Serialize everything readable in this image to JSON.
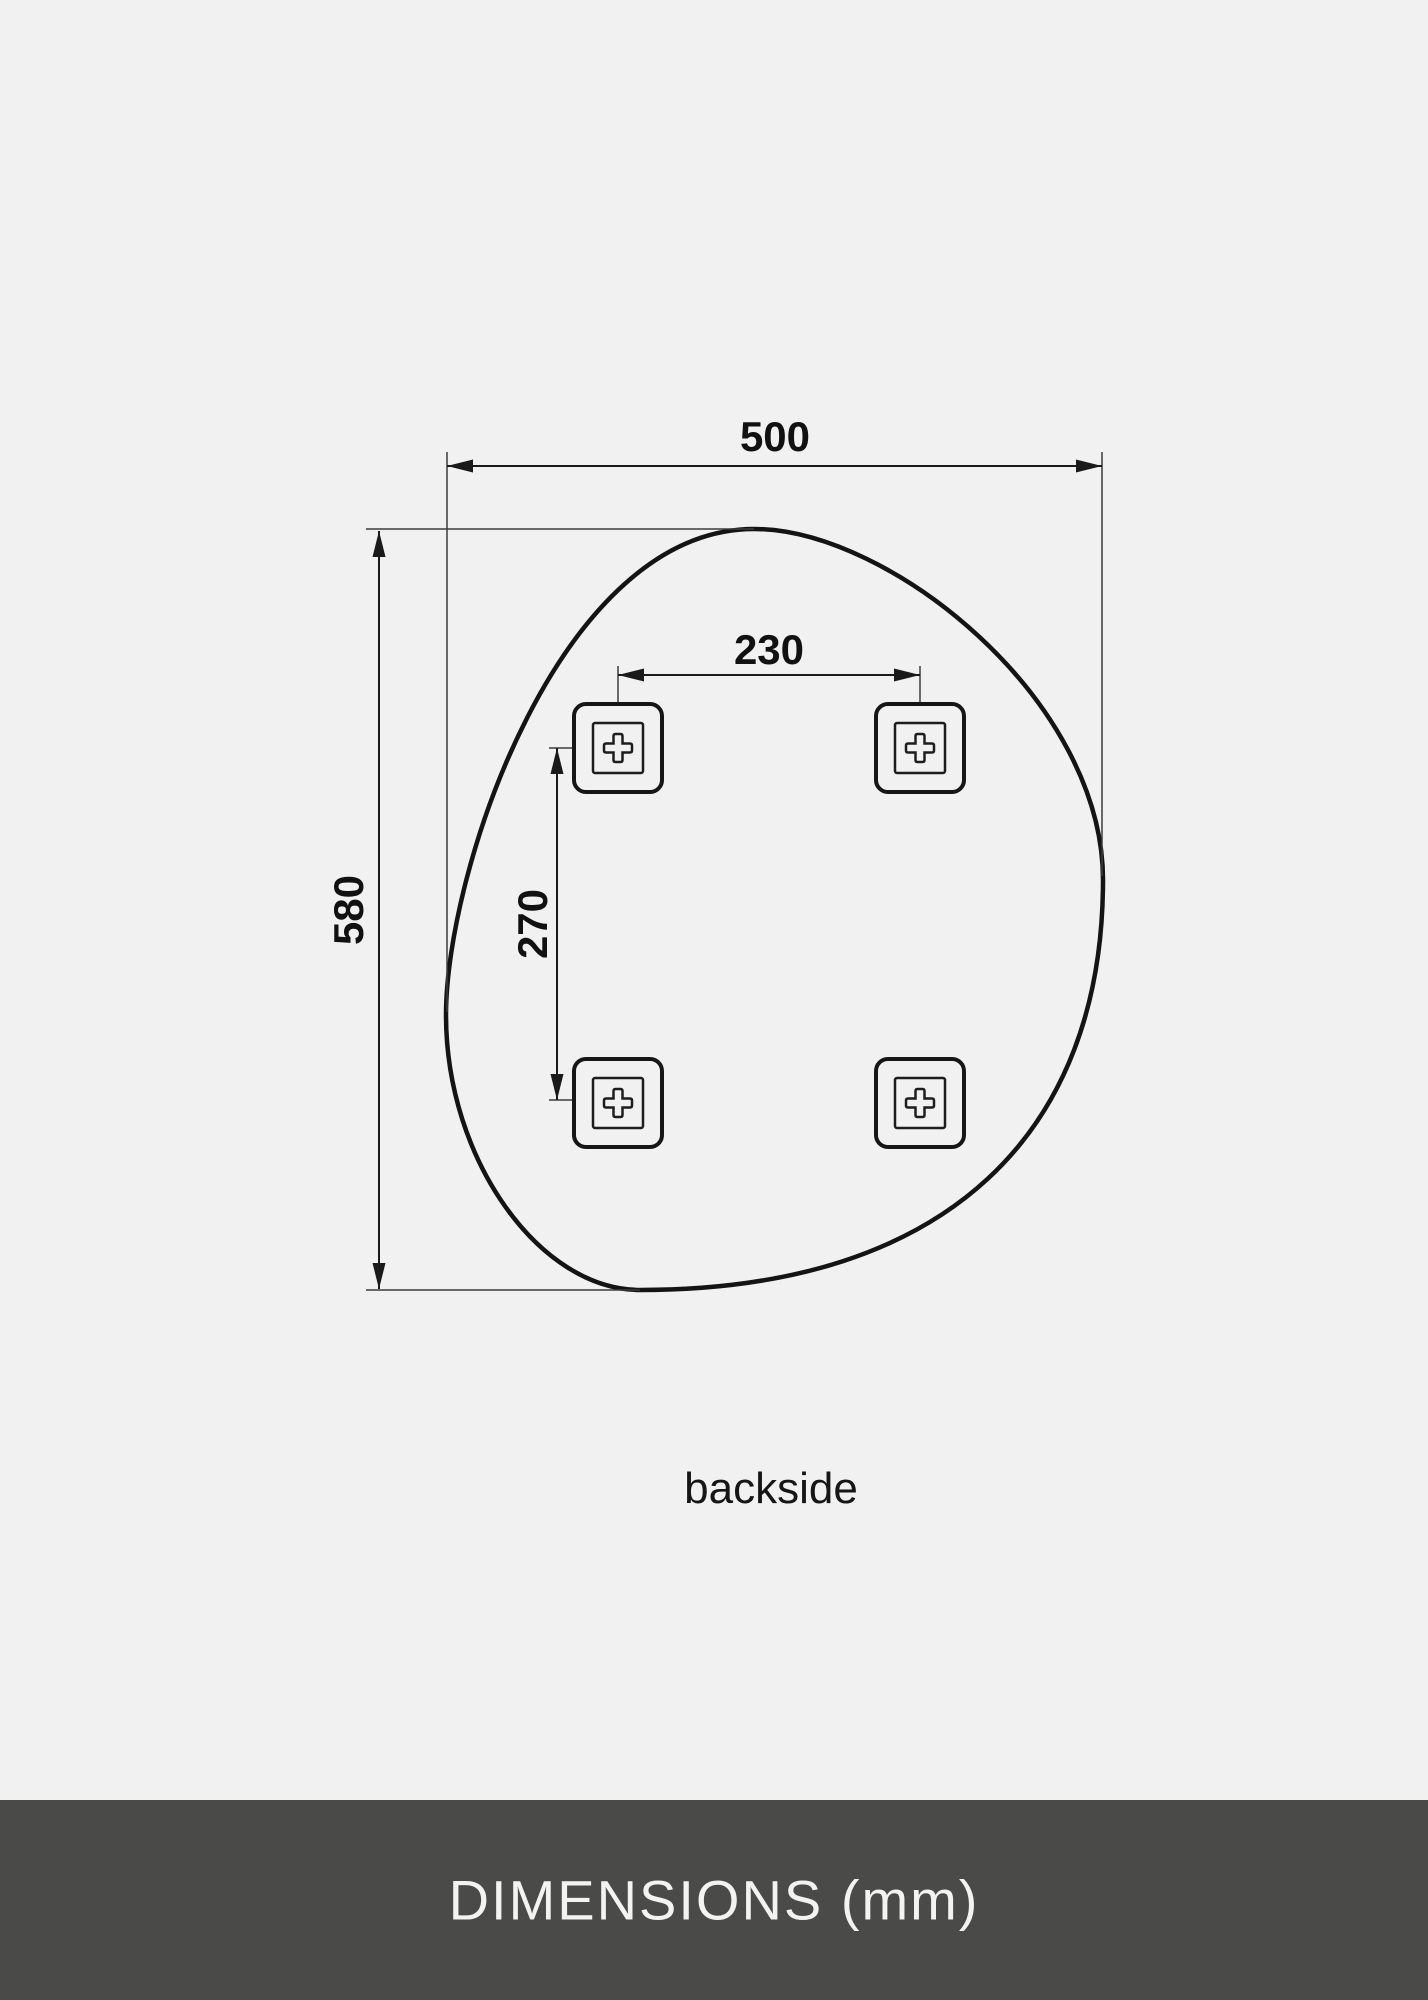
{
  "diagram": {
    "description": "Technical drawing of an organic pebble-shaped mirror seen from the back with four mounting brackets",
    "unit": "mm",
    "view_label": "backside",
    "dim_width": {
      "label": "500"
    },
    "dim_height": {
      "label": "580"
    },
    "dim_hole_spacing_h": {
      "label": "230"
    },
    "dim_hole_spacing_v": {
      "label": "270"
    },
    "icons": {
      "brackets": "mount-bracket-icon (rounded square, inner square, outlined plus)"
    },
    "colors": {
      "background": "#f1f1f1",
      "outline": "#141414",
      "dimension_lines": "#1a1a1a",
      "extension_lines": "#3c3c3c",
      "text": "#111111"
    }
  },
  "footer": {
    "title": "DIMENSIONS (mm)",
    "colors": {
      "background": "#4a4a49",
      "text": "#f3f3f2"
    }
  }
}
